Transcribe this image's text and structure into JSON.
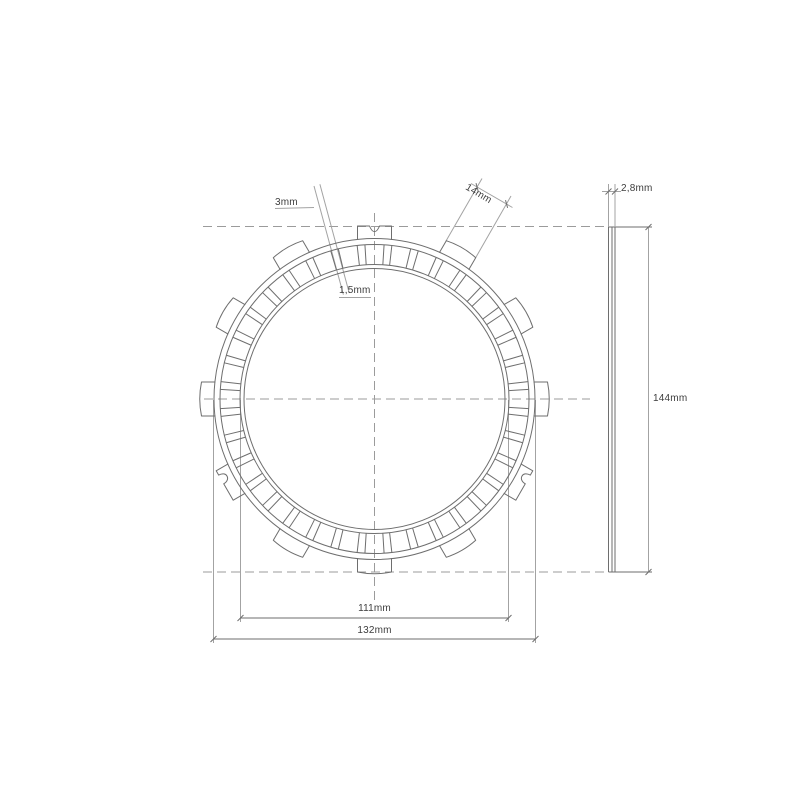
{
  "drawing": {
    "title": "clutch-friction-plate-technical-drawing",
    "colors": {
      "main": "#6e6e6e",
      "light": "#a3a3a3",
      "dash": "#9b9b9b",
      "text": "#3d3d3d",
      "background": "#ffffff"
    },
    "dash_pattern": "9,5",
    "dimensions": {
      "groove_width": {
        "label": "3mm"
      },
      "friction_thickness": {
        "label": "1,5mm"
      },
      "tab_width": {
        "label": "14mm"
      },
      "plate_thickness": {
        "label": "2,8mm"
      },
      "overall_diameter": {
        "label": "144mm"
      },
      "inner_diameter": {
        "label": "111mm"
      },
      "outer_ring_diameter": {
        "label": "132mm"
      }
    },
    "front_view": {
      "center": {
        "x": 374.5,
        "y": 399
      },
      "circles": [
        160.5,
        154.5,
        134.5,
        130.5
      ],
      "radii": {
        "pad_outer": 154.5,
        "pad_inner": 134.5
      },
      "grooves": {
        "count": 36,
        "start_deg": 5,
        "step_deg": 10,
        "half_angle_deg": 1.45
      },
      "tabs": {
        "angles_deg": [
          0,
          30,
          60,
          90,
          120,
          150,
          180,
          210,
          240,
          270,
          300,
          330
        ],
        "half_width": 17,
        "inner_r": 159,
        "outer_r": 173,
        "bulge_r": 176.5,
        "top_notch_angle": 90,
        "side_notches": [
          {
            "angle": 210,
            "offset": -7
          },
          {
            "angle": 330,
            "offset": 7
          }
        ]
      }
    },
    "side_view": {
      "verticals": [
        608.5,
        612,
        615
      ],
      "top_y": 227,
      "bottom_y": 572,
      "edge_right_x": 652
    },
    "lines": [
      {
        "x1": 203,
        "y1": 226.5,
        "x2": 606,
        "y2": 226.5,
        "s": "dash"
      },
      {
        "x1": 203,
        "y1": 572,
        "x2": 606,
        "y2": 572,
        "s": "dash"
      },
      {
        "x1": 204,
        "y1": 399,
        "x2": 590,
        "y2": 399,
        "s": "dash"
      },
      {
        "x1": 374.5,
        "y1": 213,
        "x2": 374.5,
        "y2": 600,
        "s": "dash"
      },
      {
        "x1": 314,
        "y1": 186,
        "x2": 343.4,
        "y2": 294.6,
        "s": "light"
      },
      {
        "x1": 319.9,
        "y1": 184.2,
        "x2": 349.2,
        "y2": 292.9,
        "s": "light"
      },
      {
        "x1": 275,
        "y1": 208.5,
        "x2": 314,
        "y2": 207.5,
        "s": "light"
      },
      {
        "x1": 339,
        "y1": 297.5,
        "x2": 371,
        "y2": 297.5,
        "s": "light"
      },
      {
        "x1": 475.5,
        "y1": 258,
        "x2": 511,
        "y2": 196,
        "s": "light"
      },
      {
        "x1": 446,
        "y1": 241,
        "x2": 482,
        "y2": 178.5,
        "s": "light"
      },
      {
        "x1": 471,
        "y1": 183.5,
        "x2": 512.5,
        "y2": 207.5,
        "s": "light"
      },
      {
        "x1": 476,
        "y1": 183.1,
        "x2": 478.1,
        "y2": 190.9,
        "s": "main"
      },
      {
        "x1": 505.5,
        "y1": 200.1,
        "x2": 507.6,
        "y2": 207.9,
        "s": "main"
      },
      {
        "x1": 240.5,
        "y1": 400,
        "x2": 240.5,
        "y2": 622,
        "s": "light"
      },
      {
        "x1": 508.5,
        "y1": 400,
        "x2": 508.5,
        "y2": 622,
        "s": "light"
      },
      {
        "x1": 240.5,
        "y1": 618,
        "x2": 508.5,
        "y2": 618,
        "s": "main"
      },
      {
        "x1": 237.5,
        "y1": 621,
        "x2": 243.5,
        "y2": 615,
        "s": "main"
      },
      {
        "x1": 505.5,
        "y1": 621,
        "x2": 511.5,
        "y2": 615,
        "s": "main"
      },
      {
        "x1": 213.5,
        "y1": 400,
        "x2": 213.5,
        "y2": 643,
        "s": "light"
      },
      {
        "x1": 535.5,
        "y1": 400,
        "x2": 535.5,
        "y2": 643,
        "s": "light"
      },
      {
        "x1": 213.5,
        "y1": 639,
        "x2": 535.5,
        "y2": 639,
        "s": "main"
      },
      {
        "x1": 210.5,
        "y1": 642,
        "x2": 216.5,
        "y2": 636,
        "s": "main"
      },
      {
        "x1": 532.5,
        "y1": 642,
        "x2": 538.5,
        "y2": 636,
        "s": "main"
      },
      {
        "x1": 608.5,
        "y1": 227,
        "x2": 608.5,
        "y2": 572,
        "s": "main"
      },
      {
        "x1": 612,
        "y1": 227,
        "x2": 612,
        "y2": 572,
        "s": "main"
      },
      {
        "x1": 615,
        "y1": 227,
        "x2": 615,
        "y2": 572,
        "s": "main"
      },
      {
        "x1": 608.5,
        "y1": 227,
        "x2": 652,
        "y2": 227,
        "s": "main"
      },
      {
        "x1": 608.5,
        "y1": 572,
        "x2": 652,
        "y2": 572,
        "s": "main"
      },
      {
        "x1": 648.5,
        "y1": 227,
        "x2": 648.5,
        "y2": 572,
        "s": "light"
      },
      {
        "x1": 645.5,
        "y1": 230,
        "x2": 651.5,
        "y2": 224,
        "s": "main"
      },
      {
        "x1": 645.5,
        "y1": 575,
        "x2": 651.5,
        "y2": 569,
        "s": "main"
      },
      {
        "x1": 608.5,
        "y1": 184,
        "x2": 608.5,
        "y2": 227,
        "s": "light"
      },
      {
        "x1": 615,
        "y1": 184,
        "x2": 615,
        "y2": 227,
        "s": "light"
      },
      {
        "x1": 602,
        "y1": 191.5,
        "x2": 621,
        "y2": 191.5,
        "s": "light"
      },
      {
        "x1": 605.5,
        "y1": 194.5,
        "x2": 611.5,
        "y2": 188.5,
        "s": "main"
      },
      {
        "x1": 612,
        "y1": 194.5,
        "x2": 618,
        "y2": 188.5,
        "s": "main"
      }
    ]
  }
}
